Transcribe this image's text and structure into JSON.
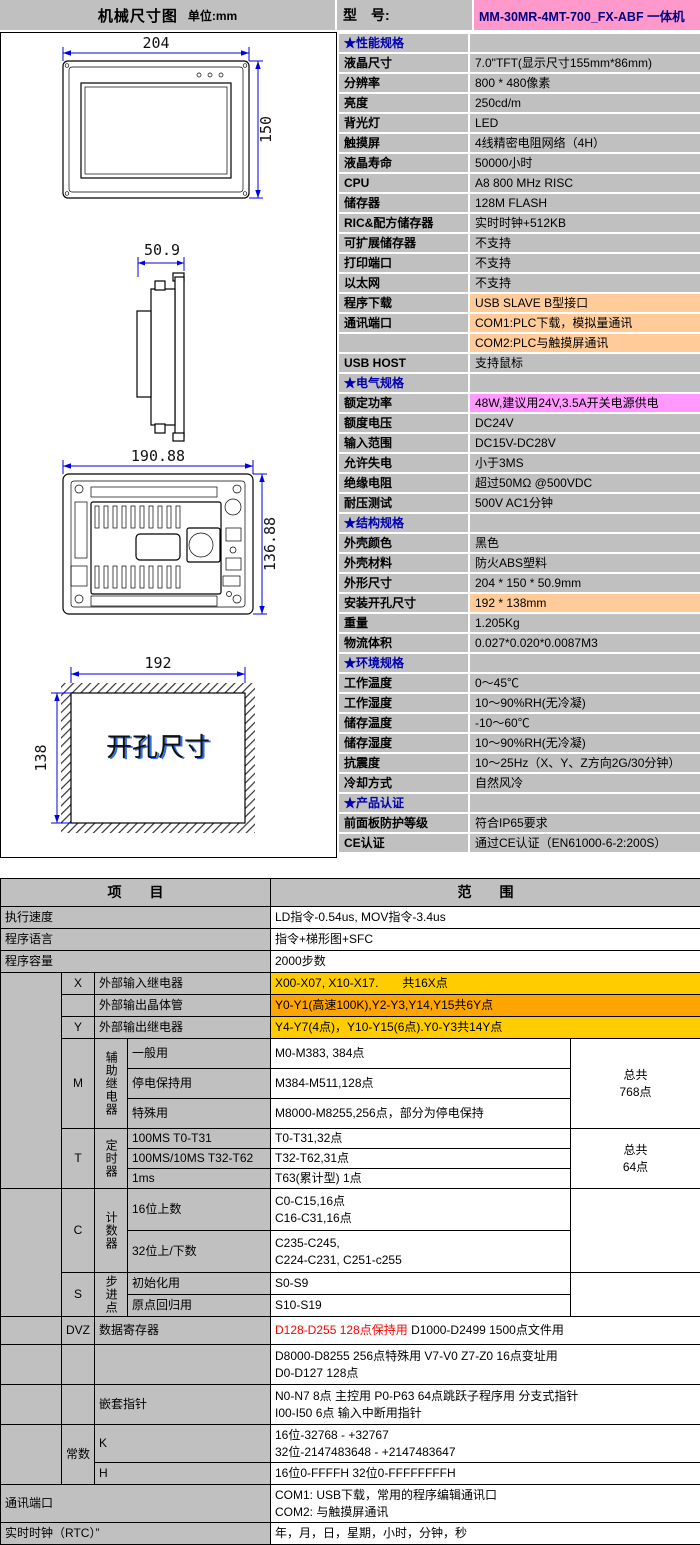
{
  "page": {
    "header": {
      "title": "机械尺寸图",
      "unit": "单位:mm",
      "model_label": "型　号:",
      "model_value": "MM-30MR-4MT-700_FX-ABF 一体机"
    },
    "colors": {
      "cell_gray": "#C0C0C0",
      "model_pink": "#FF99CC",
      "highlight_peach": "#FFCC99",
      "highlight_magenta": "#FF99FF",
      "highlight_gold": "#FFCC00",
      "highlight_orange": "#FFA500",
      "alert_red": "#FF0000",
      "section_blue": "#0000B0",
      "dimension_blue": "#0000E0"
    }
  },
  "drawings": {
    "front": {
      "width_dim": "204",
      "height_dim": "150"
    },
    "side": {
      "depth_dim": "50.9"
    },
    "rear": {
      "width_dim": "190.88",
      "height_dim": "136.88"
    },
    "cutout": {
      "width_dim": "192",
      "height_dim": "138",
      "label": "开孔尺寸"
    }
  },
  "spec": {
    "rows": [
      {
        "label": "★性能规格",
        "value": "",
        "type": "section"
      },
      {
        "label": "液晶尺寸",
        "value": "7.0\"TFT(显示尺寸155mm*86mm)"
      },
      {
        "label": "分辨率",
        "value": "800 * 480像素"
      },
      {
        "label": "亮度",
        "value": "250cd/m"
      },
      {
        "label": "背光灯",
        "value": "LED"
      },
      {
        "label": "触摸屏",
        "value": "4线精密电阻网络（4H）"
      },
      {
        "label": "液晶寿命",
        "value": "50000小时"
      },
      {
        "label": "CPU",
        "value": "A8 800 MHz RISC"
      },
      {
        "label": "储存器",
        "value": "128M FLASH"
      },
      {
        "label": "RIC&配方储存器",
        "value": "实时时钟+512KB"
      },
      {
        "label": "可扩展储存器",
        "value": "不支持"
      },
      {
        "label": "打印端口",
        "value": "不支持"
      },
      {
        "label": "以太网",
        "value": "不支持"
      },
      {
        "label": "程序下载",
        "value": "USB SLAVE B型接口",
        "vbg": "peach"
      },
      {
        "label": "通讯端口",
        "value": "COM1:PLC下载，模拟量通讯",
        "vbg": "peach"
      },
      {
        "label": "",
        "value": "COM2:PLC与触摸屏通讯",
        "vbg": "peach"
      },
      {
        "label": "USB HOST",
        "value": "支持鼠标"
      },
      {
        "label": "★电气规格",
        "value": "",
        "type": "section"
      },
      {
        "label": "额定功率",
        "value": "48W,建议用24V,3.5A开关电源供电",
        "vbg": "magenta"
      },
      {
        "label": "额度电压",
        "value": "DC24V"
      },
      {
        "label": "输入范围",
        "value": "DC15V-DC28V"
      },
      {
        "label": "允许失电",
        "value": "小于3MS"
      },
      {
        "label": "绝缘电阻",
        "value": "超过50MΩ @500VDC"
      },
      {
        "label": "耐压测试",
        "value": "500V AC1分钟"
      },
      {
        "label": "★结构规格",
        "value": "",
        "type": "section"
      },
      {
        "label": "外壳颜色",
        "value": "黑色"
      },
      {
        "label": "外壳材料",
        "value": "防火ABS塑料"
      },
      {
        "label": "外形尺寸",
        "value": "204 * 150 * 50.9mm"
      },
      {
        "label": "安装开孔尺寸",
        "value": "192 * 138mm",
        "vbg": "peach"
      },
      {
        "label": "重量",
        "value": "1.205Kg"
      },
      {
        "label": "物流体积",
        "value": "0.027*0.020*0.0087M3"
      },
      {
        "label": "★环境规格",
        "value": "",
        "type": "section"
      },
      {
        "label": "工作温度",
        "value": "0～45℃"
      },
      {
        "label": "工作湿度",
        "value": "10～90%RH(无冷凝)"
      },
      {
        "label": "储存温度",
        "value": "-10～60℃"
      },
      {
        "label": "储存湿度",
        "value": "10～90%RH(无冷凝)"
      },
      {
        "label": "抗震度",
        "value": "10～25Hz（X、Y、Z方向2G/30分钟）"
      },
      {
        "label": "冷却方式",
        "value": "自然风冷"
      },
      {
        "label": "★产品认证",
        "value": "",
        "type": "section"
      },
      {
        "label": "前面板防护等级",
        "value": "符合IP65要求"
      },
      {
        "label": "CE认证",
        "value": "通过CE认证（EN61000-6-2:200S）"
      }
    ]
  },
  "bottom_table": {
    "header": {
      "item": "项　　目",
      "range": "范　　围",
      "h": 28
    },
    "col_widths": [
      61,
      33,
      33,
      143,
      300,
      130
    ],
    "rows": [
      {
        "h": 22,
        "cells": [
          {
            "t": "执行速度",
            "cs": 4,
            "cls": "lbl",
            "n": "row-label"
          },
          {
            "t": "LD指令-0.54us, MOV指令-3.4us",
            "cs": 2,
            "cls": "val",
            "n": "row-value"
          }
        ]
      },
      {
        "h": 22,
        "cells": [
          {
            "t": "程序语言",
            "cs": 4,
            "cls": "lbl",
            "n": "row-label"
          },
          {
            "t": "指令+梯形图+SFC",
            "cs": 2,
            "cls": "val",
            "n": "row-value"
          }
        ]
      },
      {
        "h": 22,
        "cells": [
          {
            "t": "程序容量",
            "cs": 4,
            "cls": "lbl",
            "n": "row-label"
          },
          {
            "t": "2000步数",
            "cs": 2,
            "cls": "val",
            "n": "row-value"
          }
        ]
      },
      {
        "h": 22,
        "cells": [
          {
            "t": "",
            "rs": 9,
            "cls": "lbl",
            "n": "spacer-cell"
          },
          {
            "t": "X",
            "cls": "lbl ctr",
            "n": "device-letter"
          },
          {
            "t": "外部输入继电器",
            "cs": 2,
            "cls": "lbl",
            "n": "row-label"
          },
          {
            "t": "X00-X07, X10-X17.　　共16X点",
            "cs": 2,
            "cls": "val gold",
            "n": "row-value"
          }
        ]
      },
      {
        "h": 22,
        "cells": [
          {
            "t": "",
            "cls": "lbl ctr",
            "n": "device-letter"
          },
          {
            "t": "外部输出晶体管",
            "cs": 2,
            "cls": "lbl",
            "n": "row-label"
          },
          {
            "t": "Y0-Y1(高速100K),Y2-Y3,Y14,Y15共6Y点",
            "cs": 2,
            "cls": "val orange",
            "n": "row-value"
          }
        ]
      },
      {
        "h": 22,
        "cells": [
          {
            "t": "Y",
            "cls": "lbl ctr",
            "n": "device-letter"
          },
          {
            "t": "外部输出继电器",
            "cs": 2,
            "cls": "lbl",
            "n": "row-label"
          },
          {
            "t": "Y4-Y7(4点)，Y10-Y15(6点).Y0-Y3共14Y点",
            "cs": 2,
            "cls": "val gold",
            "n": "row-value"
          }
        ]
      },
      {
        "h": 30,
        "cells": [
          {
            "t": "M",
            "rs": 3,
            "cls": "lbl ctr",
            "n": "device-letter"
          },
          {
            "t": "辅助继电器",
            "rs": 3,
            "cls": "lbl vert",
            "n": "device-group-label"
          },
          {
            "t": "一般用",
            "cls": "lbl",
            "n": "row-label"
          },
          {
            "t": "M0-M383, 384点",
            "cls": "val",
            "n": "row-value"
          },
          {
            "t": "总共\n768点",
            "rs": 3,
            "cls": "val ctr",
            "n": "total-cell"
          }
        ]
      },
      {
        "h": 30,
        "cells": [
          {
            "t": "停电保持用",
            "cls": "lbl",
            "n": "row-label"
          },
          {
            "t": "M384-M511,128点",
            "cls": "val",
            "n": "row-value"
          }
        ]
      },
      {
        "h": 30,
        "cells": [
          {
            "t": "特殊用",
            "cls": "lbl",
            "n": "row-label"
          },
          {
            "t": "M8000-M8255,256点，部分为停电保持",
            "cls": "val",
            "n": "row-value"
          }
        ]
      },
      {
        "h": 20,
        "cells": [
          {
            "t": "T",
            "rs": 3,
            "cls": "lbl ctr",
            "n": "device-letter"
          },
          {
            "t": "定时器",
            "rs": 3,
            "cls": "lbl vert",
            "n": "device-group-label"
          },
          {
            "t": "100MS T0-T31",
            "cls": "lbl",
            "n": "row-label"
          },
          {
            "t": "T0-T31,32点",
            "cls": "val",
            "n": "row-value"
          },
          {
            "t": "总共\n64点",
            "rs": 3,
            "cls": "val ctr",
            "n": "total-cell"
          }
        ]
      },
      {
        "h": 20,
        "cells": [
          {
            "t": "100MS/10MS T32-T62",
            "cls": "lbl",
            "n": "row-label"
          },
          {
            "t": "T32-T62,31点",
            "cls": "val",
            "n": "row-value"
          }
        ]
      },
      {
        "h": 20,
        "cells": [
          {
            "t": "1ms",
            "cls": "lbl",
            "n": "row-label"
          },
          {
            "t": "T63(累计型) 1点",
            "cls": "val",
            "n": "row-value"
          }
        ]
      },
      {
        "h": 42,
        "cells": [
          {
            "t": "",
            "rs": 4,
            "cls": "lbl",
            "n": "spacer-cell"
          },
          {
            "t": "C",
            "rs": 2,
            "cls": "lbl ctr",
            "n": "device-letter"
          },
          {
            "t": "计数器",
            "rs": 2,
            "cls": "lbl vert",
            "n": "device-group-label"
          },
          {
            "t": "16位上数",
            "cls": "lbl",
            "n": "row-label"
          },
          {
            "t": "C0-C15,16点\nC16-C31,16点",
            "cls": "val",
            "n": "row-value"
          },
          {
            "t": "",
            "rs": 2,
            "cls": "val",
            "n": "total-cell"
          }
        ]
      },
      {
        "h": 42,
        "cells": [
          {
            "t": "32位上/下数",
            "cls": "lbl",
            "n": "row-label"
          },
          {
            "t": "C235-C245,\nC224-C231, C251-c255",
            "cls": "val",
            "n": "row-value"
          }
        ]
      },
      {
        "h": 22,
        "cells": [
          {
            "t": "S",
            "rs": 2,
            "cls": "lbl ctr",
            "n": "device-letter"
          },
          {
            "t": "步进点",
            "rs": 2,
            "cls": "lbl vert",
            "n": "device-group-label"
          },
          {
            "t": "初始化用",
            "cls": "lbl",
            "n": "row-label"
          },
          {
            "t": "S0-S9",
            "cls": "val",
            "n": "row-value"
          },
          {
            "t": "",
            "rs": 2,
            "cls": "val",
            "n": "total-cell"
          }
        ]
      },
      {
        "h": 22,
        "cells": [
          {
            "t": "原点回归用",
            "cls": "lbl",
            "n": "row-label"
          },
          {
            "t": "S10-S19",
            "cls": "val",
            "n": "row-value"
          }
        ]
      },
      {
        "h": 28,
        "cells": [
          {
            "t": "",
            "cls": "lbl",
            "n": "spacer-cell"
          },
          {
            "t": "DVZ",
            "cls": "lbl ctr",
            "n": "device-letter"
          },
          {
            "t": "数据寄存器",
            "cs": 2,
            "cls": "lbl",
            "n": "row-label"
          },
          {
            "cs": 2,
            "cls": "val",
            "n": "row-value",
            "parts": [
              {
                "t": "D128-D255 128点保持用",
                "c": "#FF0000"
              },
              {
                "t": " D1000-D2499 1500点文件用"
              }
            ]
          }
        ]
      },
      {
        "h": 40,
        "cells": [
          {
            "t": "",
            "cls": "lbl",
            "n": "spacer-cell"
          },
          {
            "t": "",
            "cls": "lbl",
            "n": "device-letter"
          },
          {
            "t": "",
            "cs": 2,
            "cls": "lbl",
            "n": "row-label"
          },
          {
            "t": "D8000-D8255 256点特殊用 V7-V0 Z7-Z0 16点变址用\nD0-D127 128点",
            "cs": 2,
            "cls": "val",
            "n": "row-value"
          }
        ]
      },
      {
        "h": 40,
        "cells": [
          {
            "t": "",
            "cls": "lbl",
            "n": "spacer-cell"
          },
          {
            "t": "",
            "cls": "lbl",
            "n": "device-letter"
          },
          {
            "t": "嵌套指针",
            "cs": 2,
            "cls": "lbl",
            "n": "row-label"
          },
          {
            "t": "N0-N7 8点 主控用 P0-P63 64点跳跃子程序用 分支式指针\nI00-I50 6点 输入中断用指针",
            "cs": 2,
            "cls": "val",
            "n": "row-value"
          }
        ]
      },
      {
        "h": 38,
        "cells": [
          {
            "t": "",
            "rs": 2,
            "cls": "lbl",
            "n": "spacer-cell"
          },
          {
            "t": "常数",
            "rs": 2,
            "cls": "lbl ctr",
            "n": "device-letter"
          },
          {
            "t": "K",
            "cs": 2,
            "cls": "lbl",
            "n": "row-label"
          },
          {
            "t": "16位-32768 - +32767\n32位-2147483648 - +2147483647",
            "cs": 2,
            "cls": "val",
            "n": "row-value"
          }
        ]
      },
      {
        "h": 22,
        "cells": [
          {
            "t": "H",
            "cs": 2,
            "cls": "lbl",
            "n": "row-label"
          },
          {
            "t": "16位0-FFFFH 32位0-FFFFFFFFH",
            "cs": 2,
            "cls": "val",
            "n": "row-value"
          }
        ]
      },
      {
        "h": 38,
        "cells": [
          {
            "t": "通讯端口",
            "cs": 4,
            "cls": "lbl",
            "n": "row-label"
          },
          {
            "t": "COM1: USB下载，常用的程序编辑通讯口\nCOM2: 与触摸屏通讯",
            "cs": 2,
            "cls": "val",
            "n": "row-value"
          }
        ]
      },
      {
        "h": 22,
        "cells": [
          {
            "t": "实时时钟（RTC）”",
            "cs": 4,
            "cls": "lbl",
            "n": "row-label"
          },
          {
            "t": "年，月，日，星期，小时，分钟，秒",
            "cs": 2,
            "cls": "val",
            "n": "row-value"
          }
        ]
      }
    ]
  }
}
